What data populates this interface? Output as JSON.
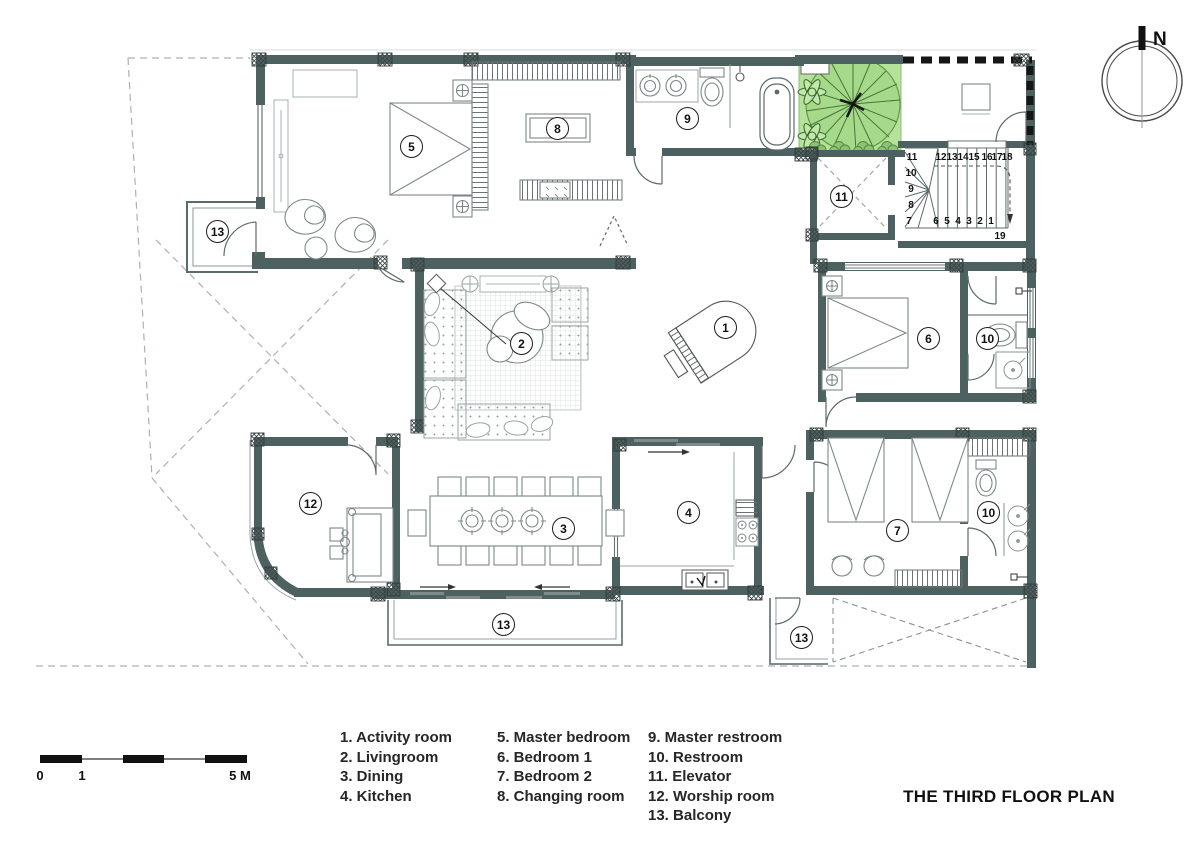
{
  "title": "THE THIRD FLOOR PLAN",
  "compass": {
    "north": "N"
  },
  "scale_bar": {
    "labels": [
      "0",
      "1",
      "5 M"
    ]
  },
  "legend": {
    "col1": [
      "1. Activity room",
      "2. Livingroom",
      "3. Dining",
      "4. Kitchen"
    ],
    "col2": [
      "5. Master bedroom",
      "6. Bedroom 1",
      "7. Bedroom 2",
      "8. Changing room"
    ],
    "col3": [
      "9. Master restroom",
      "10. Restroom",
      "11. Elevator",
      "12. Worship room",
      "13. Balcony"
    ]
  },
  "badges": [
    {
      "num": "1",
      "room": "Activity room"
    },
    {
      "num": "2",
      "room": "Livingroom"
    },
    {
      "num": "3",
      "room": "Dining"
    },
    {
      "num": "4",
      "room": "Kitchen"
    },
    {
      "num": "5",
      "room": "Master bedroom"
    },
    {
      "num": "6",
      "room": "Bedroom 1"
    },
    {
      "num": "7",
      "room": "Bedroom 2"
    },
    {
      "num": "8",
      "room": "Changing room"
    },
    {
      "num": "9",
      "room": "Master restroom"
    },
    {
      "num": "10",
      "room": "Restroom"
    },
    {
      "num": "10",
      "room": "Restroom"
    },
    {
      "num": "11",
      "room": "Elevator"
    },
    {
      "num": "12",
      "room": "Worship room"
    },
    {
      "num": "13",
      "room": "Balcony"
    },
    {
      "num": "13",
      "room": "Balcony"
    },
    {
      "num": "13",
      "room": "Balcony"
    }
  ],
  "stairs": {
    "top_row": [
      "11",
      "12",
      "13",
      "14",
      "15",
      "16",
      "17",
      "18"
    ],
    "left_col": [
      "10",
      "9",
      "8"
    ],
    "bottom_row": [
      "7",
      "6",
      "5",
      "4",
      "3",
      "2",
      "1"
    ],
    "landing": "19"
  },
  "colors": {
    "wall": "#4e6161",
    "vegetation": "#b5e29a"
  }
}
